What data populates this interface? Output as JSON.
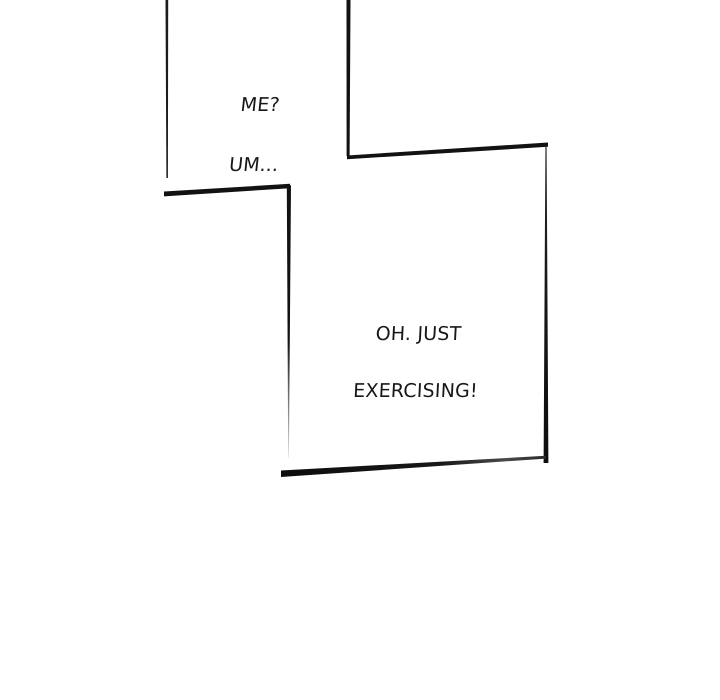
{
  "page": {
    "background_color": "#ffffff",
    "ink_color": "#171717"
  },
  "panels": [
    {
      "id": "top-panel",
      "dialogue_lines": [
        "ME?",
        "UM..."
      ]
    },
    {
      "id": "main-panel",
      "dialogue_lines": [
        "OH. JUST",
        "EXERCISING!"
      ]
    }
  ]
}
